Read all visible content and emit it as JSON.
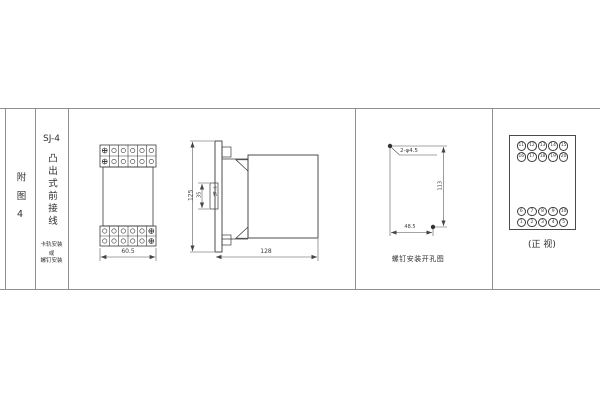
{
  "title_block": {
    "figure_label": "附图4",
    "model": "SJ-4",
    "wiring_type": "凸出式前接线",
    "mounting_note": [
      "卡轨安装",
      "或",
      "螺钉安装"
    ]
  },
  "front_view": {
    "width_dim": "60.5"
  },
  "side_view": {
    "height_dim": "125",
    "depth_dim": "128",
    "rail_height_dim": "35",
    "rail_label": "卡轨"
  },
  "drill_view": {
    "holes_label": "2-φ4.5",
    "height_dim": "113",
    "width_dim": "48.5",
    "caption": "螺钉安装开孔图"
  },
  "terminal_view": {
    "caption": "(正 视)",
    "top_rows": [
      [
        "11",
        "12",
        "13",
        "14",
        "15"
      ],
      [
        "16",
        "17",
        "18",
        "19",
        "20"
      ]
    ],
    "bottom_rows": [
      [
        "6",
        "7",
        "8",
        "9",
        "10"
      ],
      [
        "1",
        "2",
        "3",
        "4",
        "5"
      ]
    ]
  }
}
